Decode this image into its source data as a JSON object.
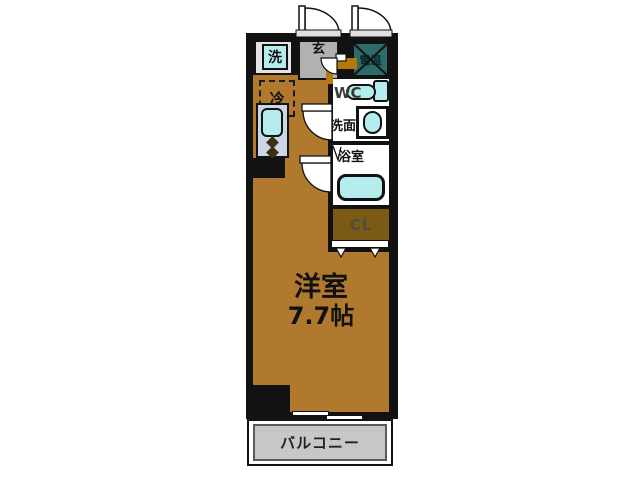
{
  "plan": {
    "rooms": {
      "main": {
        "label_line1": "洋室",
        "label_line2": "7.7帖"
      },
      "balcony": {
        "label": "バルコニー"
      },
      "wc": {
        "label": "WC"
      },
      "washroom": {
        "label": "洗面"
      },
      "bathroom": {
        "label": "浴室"
      },
      "closet": {
        "label": "CL"
      },
      "genkan": {
        "label": "玄"
      }
    },
    "fixtures": {
      "washer": {
        "label": "洗"
      },
      "water_heater": {
        "label": "電温"
      },
      "refrigerator": {
        "label": "冷"
      }
    },
    "colors": {
      "floor_brown": "#b1792e",
      "closet_brown": "#7a5a15",
      "genkan_gray": "#b3b1b0",
      "balcony_gray": "#c7c7c7",
      "fixture_cyan": "#b5ecee",
      "kitchen_counter": "#ccd6e4",
      "heater_teal": "#2d6a6a",
      "wall_black": "#121212"
    }
  }
}
